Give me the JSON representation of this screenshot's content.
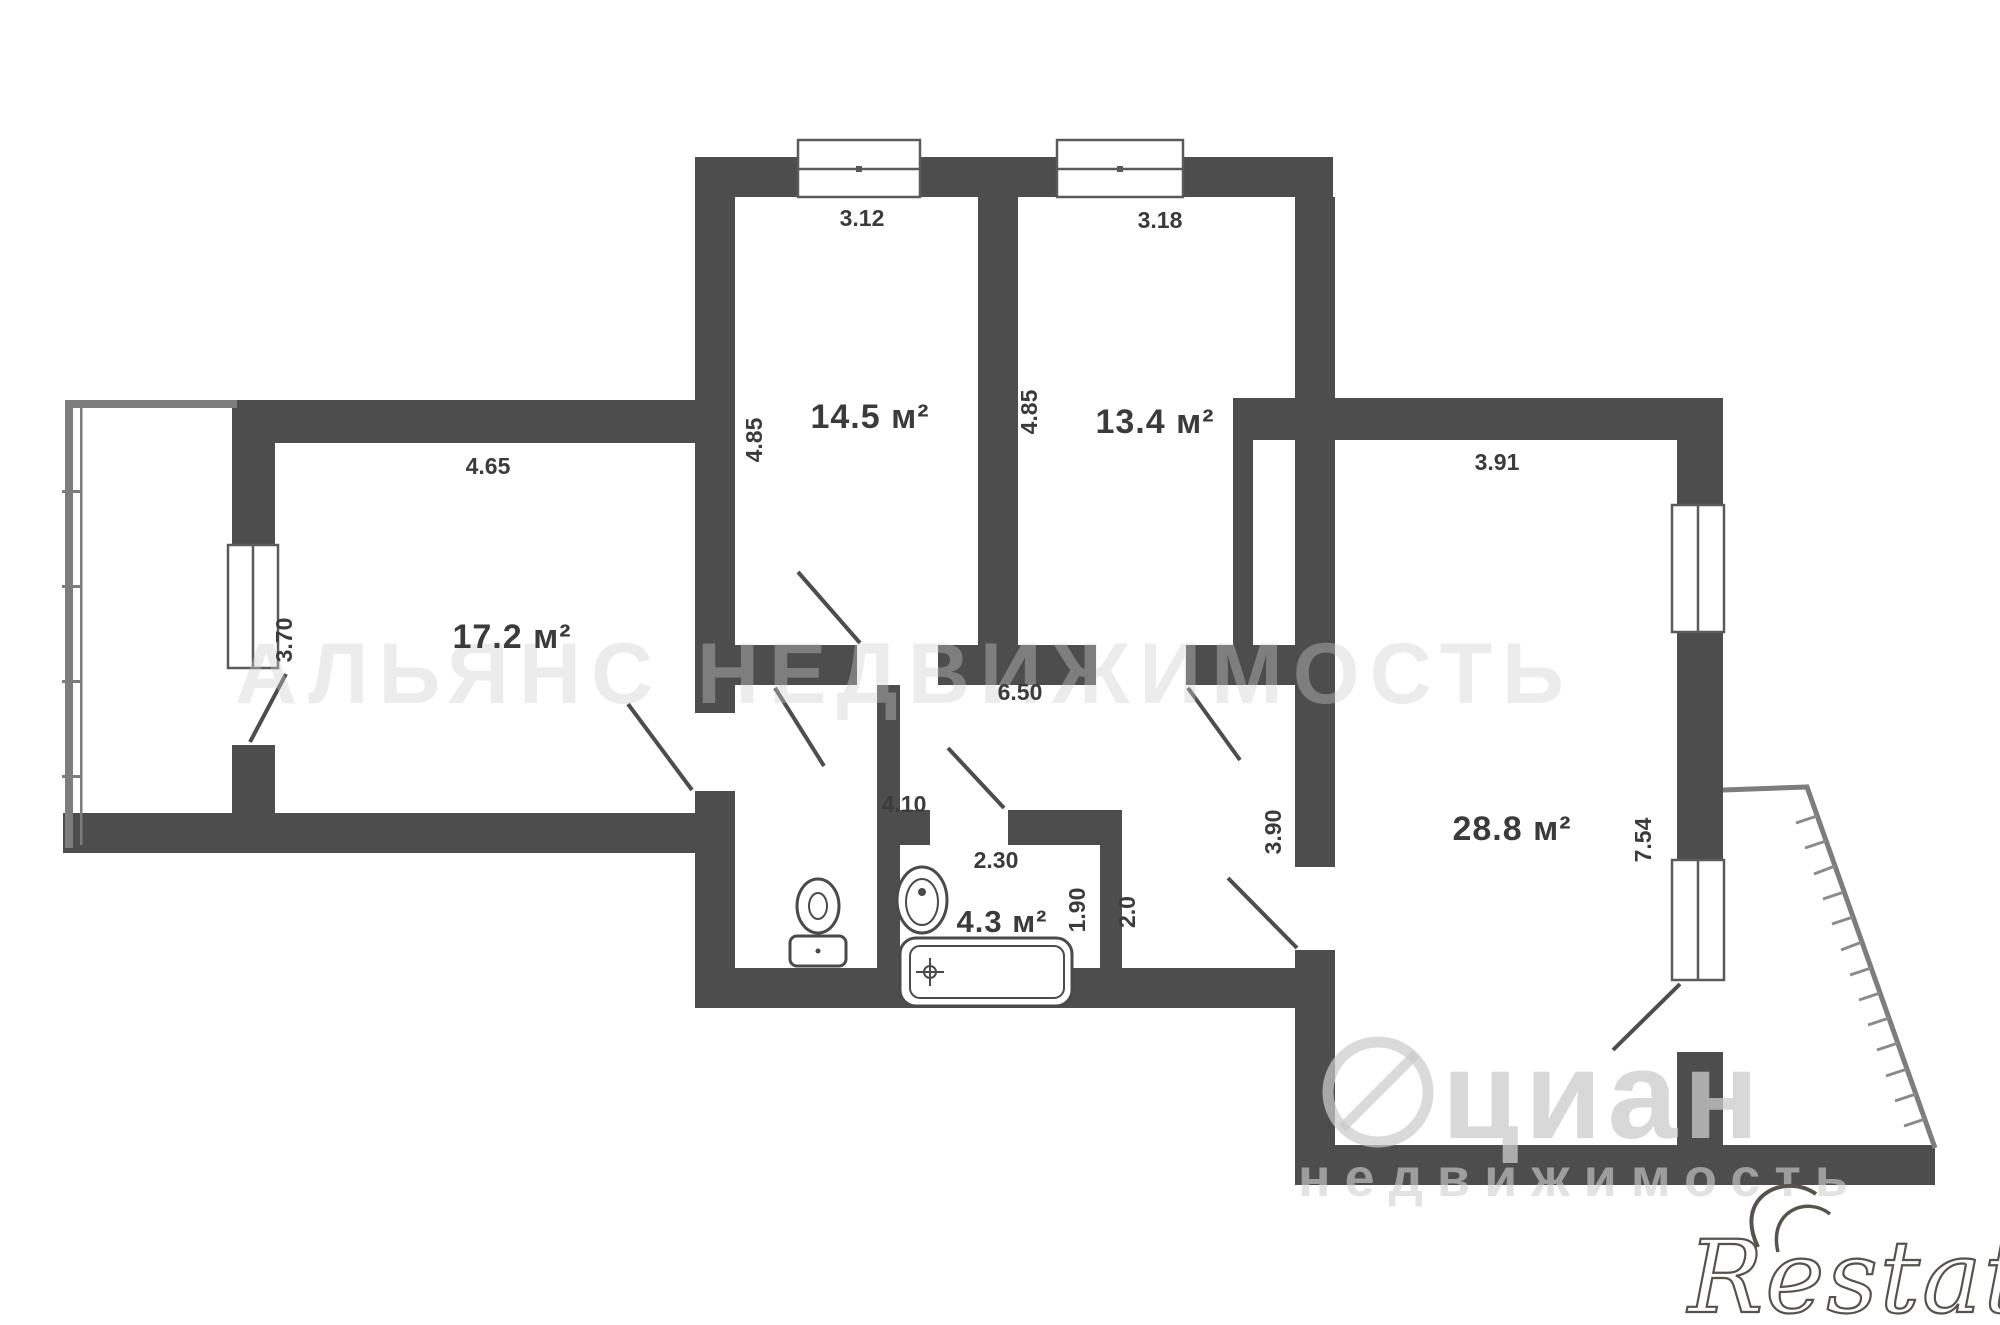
{
  "plan": {
    "rooms": [
      {
        "id": "bedroom-1",
        "area_label": "14.5 м²",
        "top_dim": "3.12",
        "side_dim": "4.85"
      },
      {
        "id": "bedroom-2",
        "area_label": "13.4 м²",
        "top_dim": "3.18",
        "side_dim": "4.85"
      },
      {
        "id": "living-room",
        "area_label": "17.2 м²",
        "top_dim": "4.65",
        "window_dim": "3.70"
      },
      {
        "id": "main-room",
        "area_label": "28.8 м²",
        "top_dim": "3.91",
        "left_dim": "3.90",
        "right_dim": "7.54"
      },
      {
        "id": "bathroom",
        "area_label": "4.3 м²",
        "top_dim": "2.30",
        "left_dim": "1.90",
        "right_dim": "2.0"
      }
    ],
    "hall": {
      "length_dim": "6.50",
      "width_dim": "4.10"
    }
  },
  "labels": {
    "room1_area": "14.5 м²",
    "room1_w": "3.12",
    "room1_h": "4.85",
    "room2_area": "13.4 м²",
    "room2_w": "3.18",
    "room2_h": "4.85",
    "room3_area": "17.2 м²",
    "room3_w": "4.65",
    "room3_h": "3.70",
    "room4_area": "28.8 м²",
    "room4_w": "3.91",
    "room4_h": "3.90",
    "room4_r": "7.54",
    "bath_area": "4.3 м²",
    "bath_w": "2.30",
    "bath_l": "1.90",
    "bath_r": "2.0",
    "hall_len": "6.50",
    "hall_w": "4.10"
  },
  "fixtures": [
    "toilet-icon",
    "sink-icon",
    "bathtub-icon"
  ],
  "watermarks": {
    "center_text": "АЛЬЯНС НЕДВИЖИМОСТЬ",
    "cian_text": "циан",
    "cian_sub_text": "недвижимость",
    "logo_text": "Restate"
  },
  "colors": {
    "wall": "#4d4d4d",
    "thin_line": "#7d7d7d",
    "fixture_line": "#4a4a4a",
    "watermark": "#cccccc"
  }
}
